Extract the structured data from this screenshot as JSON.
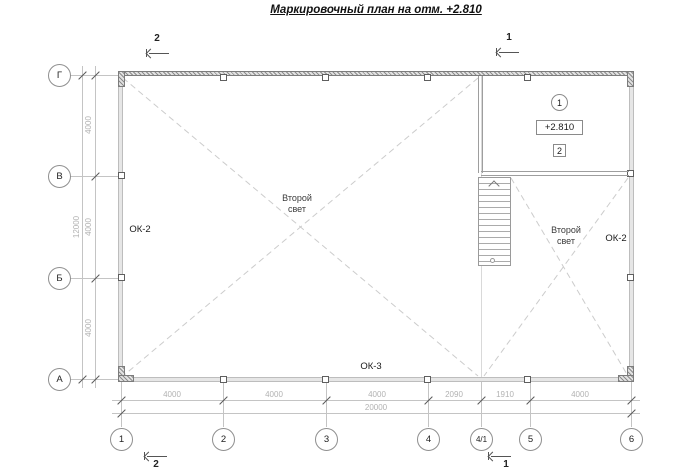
{
  "title": "Маркировочный план на отм. +2.810",
  "colors": {
    "wall_fill": "#e6e6e6",
    "grid_line": "#c9c9c9",
    "dim_text": "#b2b2b2",
    "annotation_text": "#1a1a1a"
  },
  "axes": {
    "rows": [
      "Г",
      "В",
      "Б",
      "А"
    ],
    "cols": [
      "1",
      "2",
      "3",
      "4",
      "4/1",
      "5",
      "6"
    ]
  },
  "dims": {
    "left": [
      "4000",
      "4000",
      "4000"
    ],
    "left_total": "12000",
    "bottom": [
      "4000",
      "4000",
      "4000",
      "2090",
      "1910",
      "4000"
    ],
    "bottom_total": "20000"
  },
  "sections": {
    "top_left": "2",
    "top_right": "1",
    "bottom_left": "2",
    "bottom_right": "1"
  },
  "windows": {
    "left": "ОК-2",
    "bottom": "ОК-3",
    "right": "ОК-2"
  },
  "second_light": {
    "line1": "Второй",
    "line2": "свет"
  },
  "room": {
    "position_number": "1",
    "elevation": "+2.810",
    "detail_number": "2"
  }
}
